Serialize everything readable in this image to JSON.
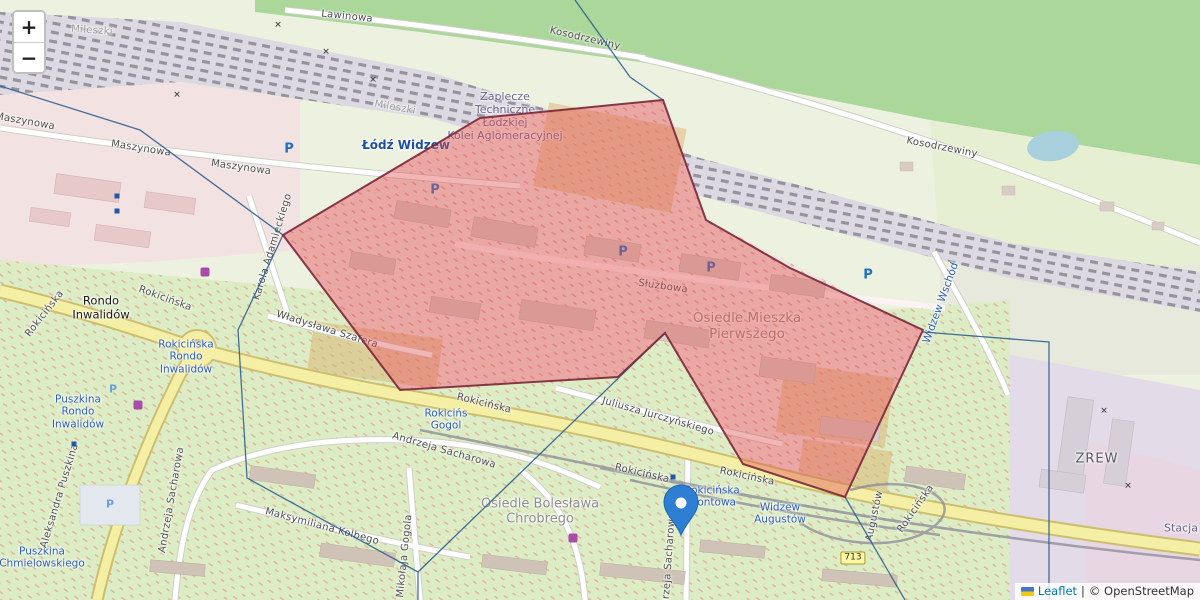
{
  "controls": {
    "zoom_in": "+",
    "zoom_out": "−"
  },
  "attribution": {
    "leaflet_link": "Leaflet",
    "separator": "|",
    "osm_credit": "© OpenStreetMap",
    "flag_icon": "ukraine-flag"
  },
  "overlay": {
    "highlight_polygon_points": "663,100 706,220 790,268 923,330 845,497 743,464 665,333 618,377 400,390 283,235 480,118",
    "highlight_stroke": "#7a2638",
    "highlight_fill": "#e05252",
    "boundary_color": "#2f5f8f",
    "boundary_paths": [
      "M0,86 L140,130 L283,235",
      "M283,235 L238,330 L247,478 L418,572 L418,600",
      "M418,572 L665,333",
      "M575,0 L630,77 L663,100",
      "M923,332 L1049,342 L1049,600",
      "M845,497 L905,600"
    ],
    "marker_icon": "blue-map-pin"
  },
  "icons": {
    "parking": "P",
    "level_crossing": "✕",
    "route_shield": "713"
  },
  "labels": {
    "lawinowa": "Lawinowa",
    "kosodrzewiny_top": "Kosodrzewiny",
    "kosodrzewiny_right": "Kosodrzewiny",
    "mileszki_a": "Mileszki",
    "mileszki_b": "Mileszki",
    "maszynowa_a": "Maszynowa",
    "maszynowa_b": "Maszynowa",
    "maszynowa_c": "Maszynowa",
    "zaplecze": "Zaplecze\nTechniczne\nŁódzkiej\nKolei Aglomeracyjnej",
    "lodz_widzew": "Łódź Widzew",
    "karola_adamieckiego": "Karola Adamieckiego",
    "wladyslawa_szafera": "Władysława Szafera",
    "rokicinska_left_vert": "Rokicińska",
    "rokicinska_left": "Rokicińska",
    "rondo_inwalidow": "Rondo\nInwalidów",
    "stop_rokicinska_rondo": "Rokicińska\nRondo\nInwalidów",
    "stop_puszkina_rondo": "Puszkina\nRondo\nInwalidów",
    "stop_puszkina_chmielowskiego": "Puszkina\nChmielowskiego",
    "aleksandra_puszkina": "Aleksandra Puszkina",
    "sacharowa_a": "Andrzeja Sacharowa",
    "sacharowa_b": "Andrzeja Sacharowa",
    "sacharowa_c": "Andrzeja Sacharowa",
    "maksymiliana_kolbego": "Maksymiliana Kolbego",
    "mikolaja_gogola": "Mikołaja Gogola",
    "osiedle_boleslawa": "Osiedle Bolesława\nChrobrego",
    "osiedle_mieszka": "Osiedle Mieszka\nPierwszego",
    "sluzbowa": "Służbowa",
    "juliusza_jurczynskiego": "Juliusza Jurczyńskiego",
    "rokicinska_mid": "Rokicińska",
    "rokicinska_mid2": "Rokicińska",
    "rokicinska_right": "Rokicińska",
    "stop_rokicinska_gogola": "Rokicińs\nGogol",
    "stop_rokicinska_frontowa": "Rokicińska\nFrontowa",
    "stop_widzew_augustow": "Widzew\nAugustów",
    "widzew_wschod": "Widzew Wschód",
    "augustow_street": "Augustów",
    "rokicinska_right_vert": "Rokicińska",
    "zrew": "ZREW",
    "stacja": "Stacja"
  }
}
